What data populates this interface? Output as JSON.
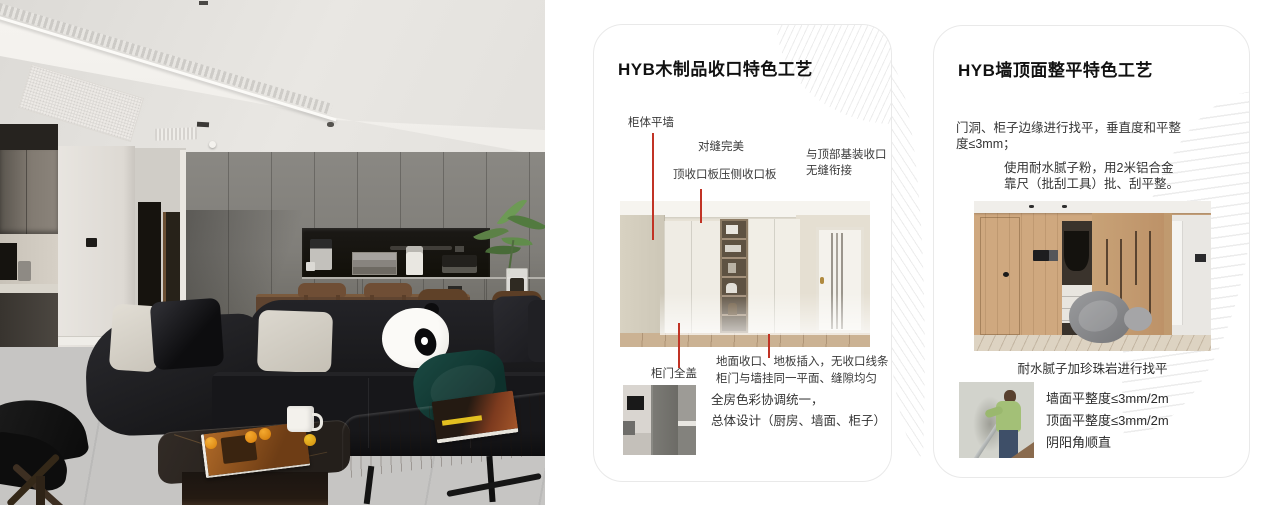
{
  "photo": {
    "description": "modern living room with black leather sofa, panda plush pillow, dining table, grey cabinet wall with appliance niche, plant and two coffee tables"
  },
  "cards": [
    {
      "title": "HYB木制品收口特色工艺",
      "annotations": {
        "cabinet_flush_wall": "柜体平墙",
        "perfect_seam": "对缝完美",
        "top_closure_panel": "顶收口板压侧收口板",
        "ceiling_joint": "与顶部基装收口\n无缝衔接",
        "door_full_cover": "柜门全盖",
        "floor_note": "地面收口、地板插入，无收口线条\n柜门与墙挂同一平面、缝隙均匀"
      },
      "footer_note": "全房色彩协调统一，\n总体设计（厨房、墙面、柜子）"
    },
    {
      "title": "HYB墙顶面整平特色工艺",
      "para1": "门洞、柜子边缘进行找平，垂直度和平整\n度≤3mm；",
      "para2": "使用耐水腻子粉，用2米铝合金\n靠尺（批刮工具）批、刮平整。",
      "caption": "耐水腻子加珍珠岩进行找平",
      "metrics": [
        "墙面平整度≤3mm/2m",
        "顶面平整度≤3mm/2m",
        "阴阳角顺直"
      ]
    }
  ],
  "colors": {
    "accent_red": "#c13325",
    "card_border": "#e9e9e9",
    "pattern_line": "#ececec",
    "title_text": "#111111",
    "body_text": "#333333"
  }
}
